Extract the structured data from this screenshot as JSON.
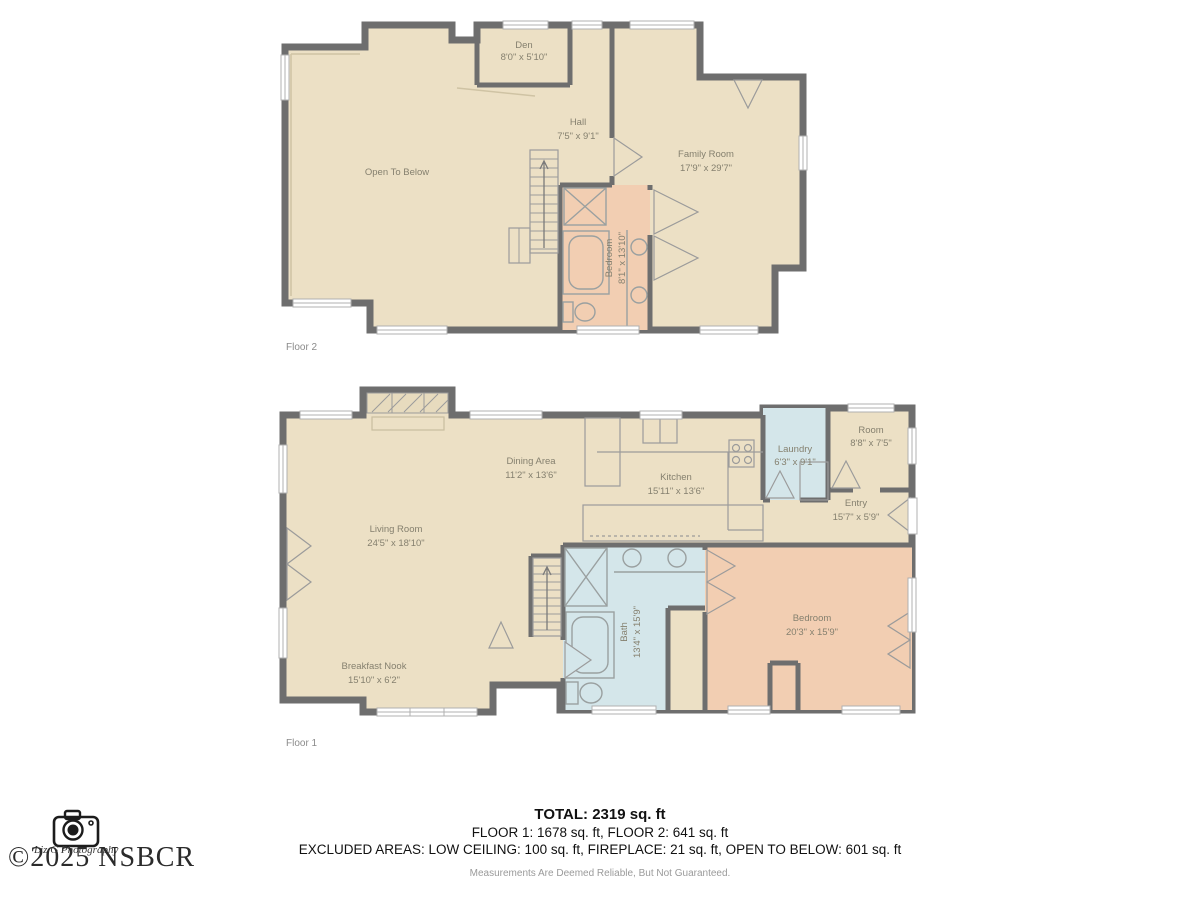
{
  "colors": {
    "wall": "#6e6e6e",
    "floor_beige": "#ece0c5",
    "room_pink": "#f2ceb2",
    "room_blue": "#d4e6ea",
    "label_text": "#85806f"
  },
  "floor2": {
    "name": "Floor 2",
    "rooms": [
      {
        "label": "Open To Below",
        "dims": ""
      },
      {
        "label": "Den",
        "dims": "8'0\" x 5'10\""
      },
      {
        "label": "Hall",
        "dims": "7'5\" x 9'1\""
      },
      {
        "label": "Family Room",
        "dims": "17'9\" x 29'7\""
      },
      {
        "label": "Bedroom",
        "dims": "8'1\" x 13'10\""
      }
    ]
  },
  "floor1": {
    "name": "Floor 1",
    "rooms": [
      {
        "label": "Living Room",
        "dims": "24'5\" x 18'10\""
      },
      {
        "label": "Dining Area",
        "dims": "11'2\" x 13'6\""
      },
      {
        "label": "Kitchen",
        "dims": "15'11\" x 13'6\""
      },
      {
        "label": "Laundry",
        "dims": "6'3\" x 9'1\""
      },
      {
        "label": "Room",
        "dims": "8'8\" x 7'5\""
      },
      {
        "label": "Entry",
        "dims": "15'7\" x 5'9\""
      },
      {
        "label": "Bath",
        "dims": "13'4\" x 15'9\""
      },
      {
        "label": "Bedroom",
        "dims": "20'3\" x 15'9\""
      },
      {
        "label": "Breakfast Nook",
        "dims": "15'10\" x 6'2\""
      }
    ]
  },
  "footer": {
    "total": "TOTAL: 2319 sq. ft",
    "floors": "FLOOR 1: 1678 sq. ft, FLOOR 2: 641 sq. ft",
    "excluded": "EXCLUDED AREAS: LOW CEILING: 100 sq. ft, FIREPLACE: 21 sq. ft, OPEN TO BELOW: 601 sq. ft",
    "disclaimer": "Measurements Are Deemed Reliable, But Not Guaranteed."
  },
  "watermark": {
    "studio": "Liz G Photography",
    "copyright": "©2025 NSBCR",
    "icon": "camera-icon"
  }
}
